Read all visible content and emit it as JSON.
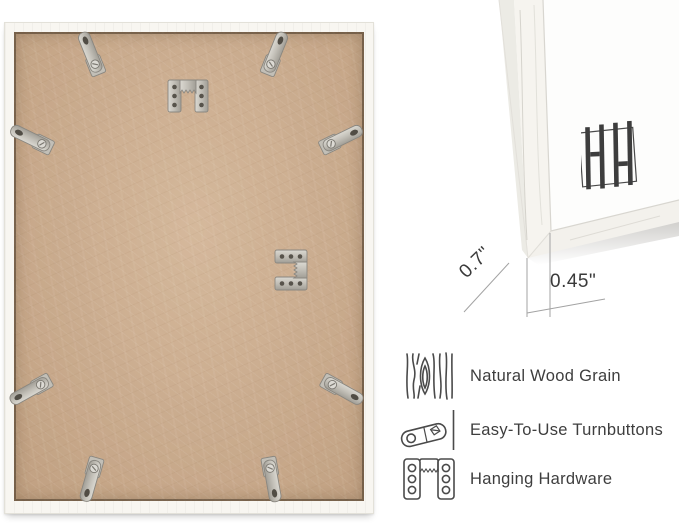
{
  "product_image": {
    "background_color": "#ffffff",
    "frame_back_photo": {
      "frame_color": "#f8f6f1",
      "backing_color": "#c9aa8c",
      "hardware_color": "#c6c3bb",
      "turnbutton_count": 8,
      "sawtooth_hanger_count": 2
    },
    "corner_detail": {
      "depth_label": "0.7\"",
      "face_width_label": "0.45\"",
      "logo": "HH monogram"
    },
    "features": {
      "items": [
        {
          "icon": "wood-grain-icon",
          "label": "Natural Wood Grain"
        },
        {
          "icon": "turnbutton-icon",
          "label": "Easy-To-Use Turnbuttons"
        },
        {
          "icon": "sawtooth-hanger-icon",
          "label": "Hanging Hardware"
        }
      ]
    }
  }
}
